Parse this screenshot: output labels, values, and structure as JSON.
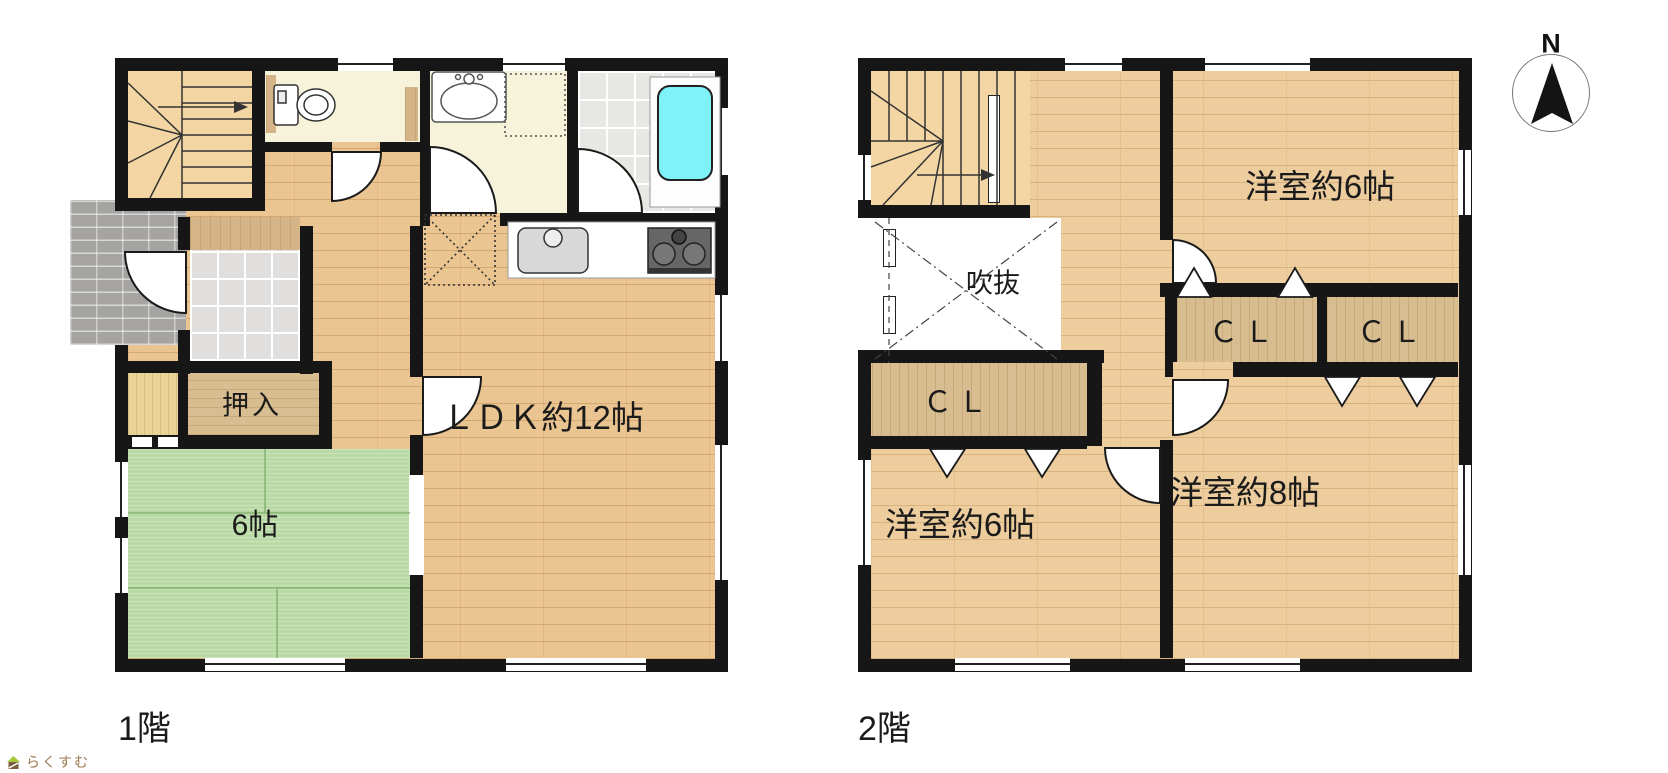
{
  "page": {
    "background": "#ffffff"
  },
  "floors": {
    "floor1": {
      "label": "1階",
      "rooms": {
        "oshiire": "押入",
        "tatami": "6帖",
        "ldk": "ＬＤＫ約12帖"
      }
    },
    "floor2": {
      "label": "2階",
      "rooms": {
        "fukinuke": "吹抜",
        "cl_west": "ＣＬ",
        "cl_mid": "ＣＬ",
        "cl_east": "ＣＬ",
        "bedroom6_north": "洋室約6帖",
        "bedroom6_south": "洋室約6帖",
        "bedroom8": "洋室約8帖"
      }
    }
  },
  "compass": {
    "label": "N"
  },
  "logo": {
    "text": "らくすむ"
  },
  "colors": {
    "wall": "#161616",
    "wood_floor_1f": "#ebc591",
    "wood_floor_2f": "#edcd9d",
    "tatami_green": "#b9d9a5",
    "bathtub_cyan": "#7ef2f6",
    "cream_room": "#f6f3da",
    "bath_tile": "#e7e7e3",
    "closet_wood": "#d8bd90",
    "stairs_tan": "#f4d6a4",
    "porch_gray": "#a5a4a2",
    "logo_brown": "#9c7a52"
  }
}
